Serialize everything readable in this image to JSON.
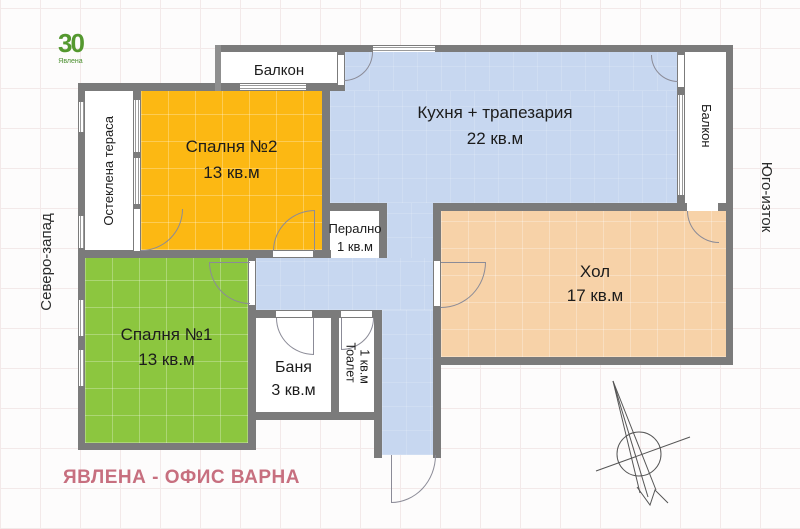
{
  "branding": {
    "logo_number": "30",
    "logo_sub": "Явлена",
    "footer": "ЯВЛЕНА - ОФИС ВАРНА"
  },
  "orientation": {
    "northwest": "Северо-запад",
    "southeast": "Юго-изток"
  },
  "rooms": {
    "balcony_top": {
      "name": "Балкон"
    },
    "terrace": {
      "name": "Остеклена тераса"
    },
    "bedroom2": {
      "name": "Спалня №2",
      "area": "13 кв.м"
    },
    "kitchen": {
      "name": "Кухня + трапезария",
      "area": "22 кв.м"
    },
    "balcony_right": {
      "name": "Балкон"
    },
    "laundry": {
      "name": "Перално",
      "area": "1 кв.м"
    },
    "living": {
      "name": "Хол",
      "area": "17 кв.м"
    },
    "bedroom1": {
      "name": "Спалня №1",
      "area": "13 кв.м"
    },
    "bath": {
      "name": "Баня",
      "area": "3 кв.м"
    },
    "toilet": {
      "name": "Тоалет",
      "area": "1 кв.м"
    }
  },
  "colors": {
    "wall": "#7b7b7b",
    "kitchen_blue": "#c7d7f0",
    "bedroom2_orange": "#fcb813",
    "bedroom1_green": "#8cc63f",
    "living_peach": "#f7d2a8",
    "white_room": "#ffffff",
    "brand_pink": "#c76f7f",
    "logo_green": "#54982f"
  }
}
